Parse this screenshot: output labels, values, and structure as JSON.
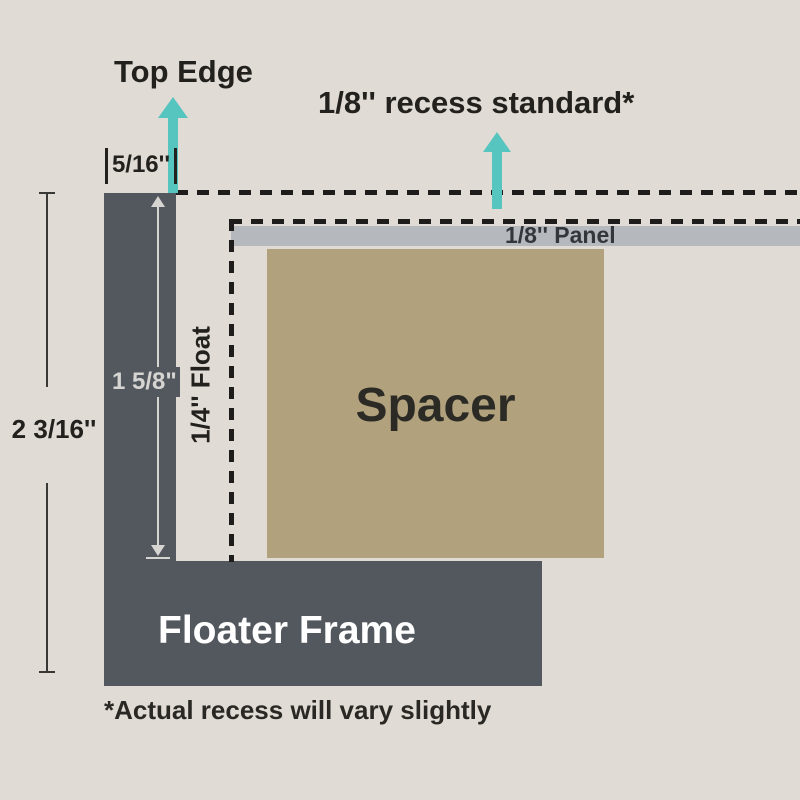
{
  "colors": {
    "background": "#e0dbd4",
    "frame": "#53585e",
    "panel": "#b5b8bc",
    "spacer": "#b1a27d",
    "arrow_teal": "#56c4bf",
    "text_dark": "#23211e",
    "text_white": "#ffffff",
    "dimension_light": "#d6d5d2"
  },
  "annotations": {
    "top_edge": "Top Edge",
    "recess_standard": "1/8'' recess standard*",
    "footnote": "*Actual recess will vary slightly"
  },
  "parts": {
    "panel": "1/8'' Panel",
    "spacer": "Spacer",
    "floater_frame": "Floater Frame"
  },
  "measurements": {
    "recess_width": "5/16''",
    "inner_depth": "1 5/8\"",
    "float_gap": "1/4'' Float",
    "total_depth": "2 3/16''"
  }
}
